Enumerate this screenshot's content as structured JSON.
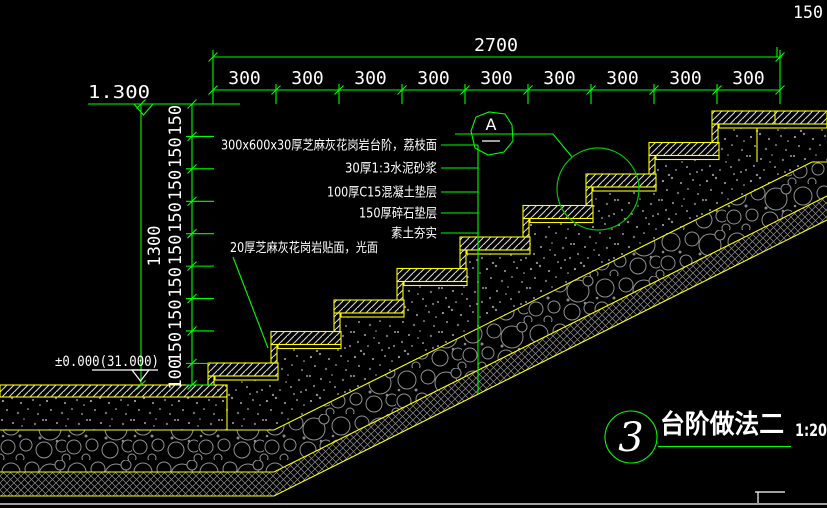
{
  "drawing": {
    "dims": {
      "top": {
        "total": "2700",
        "segments": [
          "300",
          "300",
          "300",
          "300",
          "300",
          "300",
          "300",
          "300",
          "300"
        ]
      },
      "left": {
        "total": "1300",
        "segments": [
          "150",
          "150",
          "150",
          "150",
          "150",
          "150",
          "150",
          "150",
          "100"
        ]
      },
      "corner": "150"
    },
    "levels": {
      "upper": "1.300",
      "lower": "±0.000(31.000)"
    },
    "marker": {
      "letter": "A"
    },
    "callouts": {
      "layers": [
        "300x600x30厚芝麻灰花岗岩台阶，荔枝面",
        "30厚1:3水泥砂浆",
        "100厚C15混凝土垫层",
        "150厚碎石垫层",
        "素土夯实"
      ],
      "riser": "20厚芝麻灰花岗岩贴面，光面"
    },
    "title": {
      "number": "3",
      "name": "台阶做法二",
      "scale": "1:20"
    },
    "colors": {
      "dimension_green": "#00ff00",
      "detail_green": "#00c800",
      "outline_yellow": "#ffff00",
      "text_white": "#ffffff",
      "background": "#000000"
    }
  }
}
